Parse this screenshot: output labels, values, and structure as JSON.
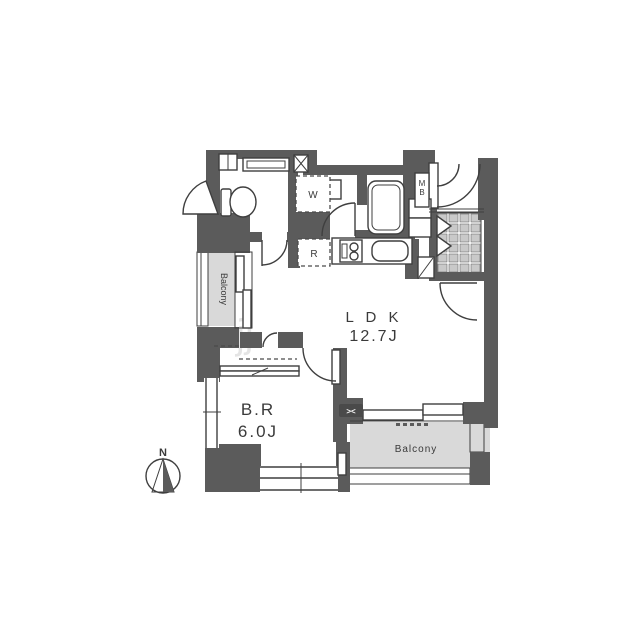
{
  "plan": {
    "rooms": {
      "ldk": {
        "label": "L D K",
        "size": "12.7J"
      },
      "bedroom": {
        "label": "B.R",
        "size": "6.0J"
      },
      "balcony_left": {
        "label": "Balcony"
      },
      "balcony_south": {
        "label": "Balcony"
      }
    },
    "markers": {
      "meter_box_letters": [
        "M",
        "B"
      ],
      "washing_machine": "W",
      "refrigerator": "R",
      "balcony_partition": "><",
      "compass_north": "N"
    },
    "watermark": "jj",
    "colors": {
      "wall": "#5b5b5b",
      "line": "#3f3f3f",
      "balcony_fill": "#d9d9d9",
      "tile_fill": "#c9c9c9",
      "text": "#3a3a3a",
      "background": "#ffffff"
    }
  }
}
